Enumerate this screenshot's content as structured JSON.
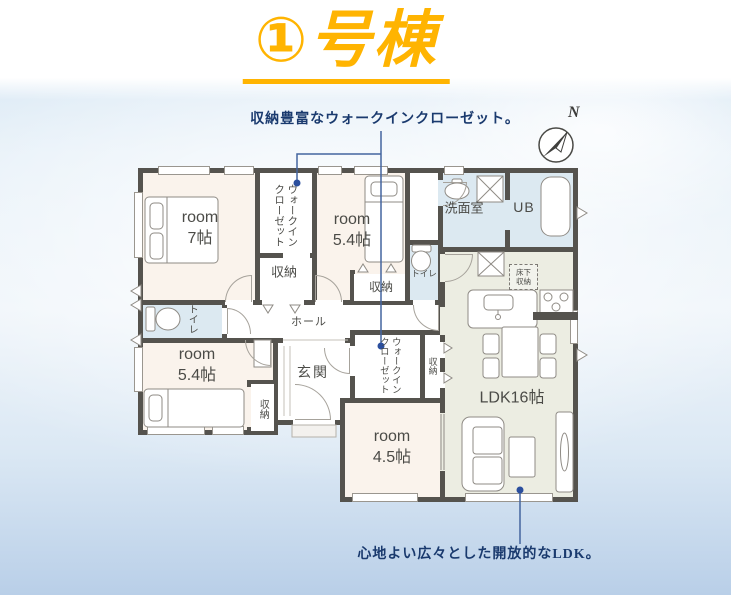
{
  "title": "①号棟",
  "notes": {
    "top": "収納豊富なウォークインクローゼット。",
    "bottom": "心地よい広々とした開放的なLDK。"
  },
  "compass": {
    "label": "N"
  },
  "plan": {
    "rooms": {
      "room7": {
        "name": "room",
        "size": "7帖"
      },
      "room54_north": {
        "name": "room",
        "size": "5.4帖"
      },
      "room54_west": {
        "name": "room",
        "size": "5.4帖"
      },
      "room45": {
        "name": "room",
        "size": "4.5帖"
      },
      "ldk": {
        "label": "LDK16帖"
      },
      "washroom": {
        "label": "洗面室"
      },
      "unit_bath": {
        "label": "UB"
      },
      "toilet_west": {
        "label": "トイレ"
      },
      "toilet_center": {
        "label": "トイレ"
      },
      "hall": {
        "label": "ホール"
      },
      "entrance": {
        "label": "玄関"
      },
      "wic_north": {
        "label": "ウォークインクローゼット"
      },
      "wic_center": {
        "label": "ウォークインクローゼット"
      },
      "closet_north_a": {
        "label": "収納"
      },
      "closet_north_b": {
        "label": "収納"
      },
      "closet_west": {
        "label": "収納"
      },
      "closet_center": {
        "label": "収納"
      },
      "underfloor_storage": {
        "label": "床下収納"
      }
    }
  },
  "colors": {
    "accent": "#FFB401",
    "note_text": "#1A3A6E",
    "wall": "#55534E",
    "room_floor": "#FAF3EC",
    "wet_floor": "#DCE9F1",
    "ldk_floor": "#ECEDE2",
    "leader_line": "#44659F"
  }
}
